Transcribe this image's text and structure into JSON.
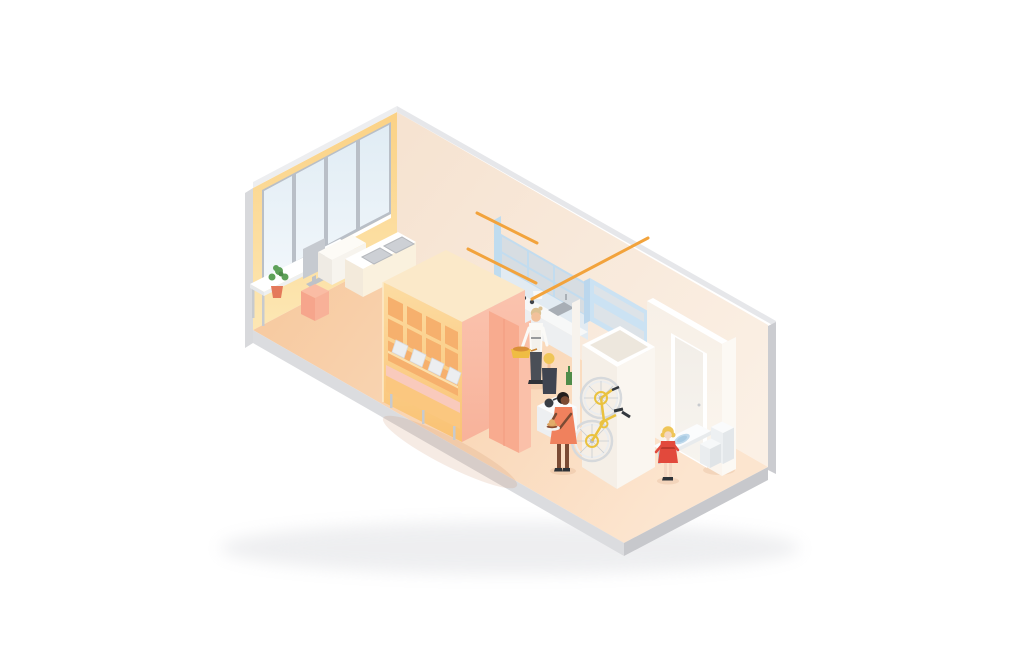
{
  "scene": {
    "description": "Isometric cutaway illustration of a compact studio apartment with window wall, desk, shelving bench unit, kitchen, bicycle storage closet, entry wall with door, fold-out washbasin table and toilet",
    "objects": [
      "window-wall",
      "desk-with-monitor",
      "potted-plant",
      "pink-storage-box",
      "sideboard",
      "cooktop-counter",
      "shelving-bench-unit",
      "wardrobe",
      "kitchen-cabinets",
      "kitchen-counter-sink",
      "chef-figure",
      "blonde-woman-figure",
      "serving-woman-figure",
      "kitchen-cart",
      "hanging-rails",
      "storage-closet",
      "wall-mounted-bicycle",
      "entry-wall-door",
      "fold-out-basin-table",
      "girl-figure",
      "toilet"
    ]
  },
  "colors": {
    "background": "#ffffff",
    "soft_shadow": "#cfd0d6",
    "slab_light": "#dbdcdf",
    "slab_dark": "#c7c8cc",
    "slab_edge_left": "#d8d9dc",
    "slab_top_nw": "#edeef0",
    "slab_top_ne": "#e6e7ea",
    "slab_right": "#cbccd0",
    "wall_yellow_top": "#fbd184",
    "wall_yellow_bottom": "#fce7b4",
    "wall_cream_dark": "#f6e3d1",
    "wall_cream_light": "#fbf0e5",
    "floor_dark": "#f7cba2",
    "floor_light": "#fce5cf",
    "window_frame": "#b9bfc7",
    "pane_top": "#e0ecf4",
    "pane_bottom": "#f2f7fb",
    "sill": "#ffffff",
    "desk_top": "#ffffff",
    "desk_edge": "#eef0f1",
    "desk_side": "#e6e8ea",
    "leg_gray": "#c7cace",
    "monitor": "#c6cad0",
    "monitor_stand": "#bec2c8",
    "keyboard": "#dadde0",
    "pot_orange": "#e4795a",
    "plant_green": "#5ea159",
    "plant_green_dark": "#4c8a49",
    "box_pink_top": "#fabca4",
    "box_pink_left": "#f6a58c",
    "box_pink_right": "#f8b198",
    "sideboard_top": "#fdfbf6",
    "sideboard_front": "#f7f4ee",
    "sideboard_side": "#efebe4",
    "counter_top": "#ffffff",
    "counter_front": "#faf1de",
    "counter_side": "#f3eadb",
    "hob_gray": "#cdd0d5",
    "hob_border": "#b5b8bd",
    "shelf_top": "#fbe9c9",
    "shelf_face_light": "#fcdca2",
    "shelf_face_dark": "#fac172",
    "cubby": "#f6b06d",
    "shelf_line": "#fce0ac",
    "shelf_edge_light": "#fdebc8",
    "salmon_light": "#fac3ae",
    "salmon_dark": "#f8b29a",
    "wardrobe_front": "#f8ab8f",
    "wardrobe_side": "#fac0a9",
    "wardrobe_seam": "#f29b7f",
    "bench_seat": "#f9cabc",
    "bench_front": "#fbc77f",
    "cushion": "#eceef0",
    "cushion_edge": "#d9dbde",
    "kitchen_blue_side": "#bfdcef",
    "cabinet_band": "#d7dde2",
    "cabinet_frame": "#c2dcef",
    "kitchen_wall": "#e2ebf2",
    "fridge_face": "#cbe2f3",
    "fridge_side": "#bbd7ed",
    "fridge_panel": "#dde3e8",
    "kcounter_top": "#f7f8f8",
    "kcounter_front": "#edeff1",
    "sink": "#a8aeb5",
    "faucet": "#9aa0a7",
    "rail_orange": "#f2a33c",
    "white_wall_warm": "#f5efe7",
    "white_wall_bright": "#faf6f0",
    "wall_interior": "#ede7dd",
    "wall_top_white": "#ffffff",
    "corridor_face_top": "#f7f0e7",
    "corridor_face_bottom": "#fbf5ee",
    "corridor_return": "#fcf9f4",
    "door_frame": "#ffffff",
    "door_top": "#f2eee8",
    "door_bottom": "#f7f4ef",
    "door_handle": "#c8cbcf",
    "column_white": "#f7f3ed",
    "table_top": "#fbfcfd",
    "table_edge": "#e8ebed",
    "basin_outer": "#bfd9ec",
    "basin_inner": "#a9cbe3",
    "toilet_top": "#fafbfc",
    "toilet_front": "#edf0f2",
    "toilet_side": "#e3e7ea",
    "bowl_top": "#f6f8f9",
    "bowl_front": "#eaedef",
    "bowl_side": "#e0e4e7",
    "skin_light": "#f2c19b",
    "skin_pale": "#f4d7c2",
    "skin_dark": "#7b4b34",
    "hair_blonde": "#efc557",
    "hair_sandy": "#dcc293",
    "hair_black": "#241f1e",
    "chef_white": "#fbfaf7",
    "apron": "#f3f1ec",
    "apron_tie": "#3e434b",
    "pants_dark": "#4a4f57",
    "shoe_dark": "#2e3237",
    "top_slate": "#3f4450",
    "dress_coral": "#f0815d",
    "dress_red": "#e2493c",
    "belt_red": "#b03228",
    "pot_yellow": "#efbc43",
    "pot_food": "#d98f39",
    "pot_handle": "#c98432",
    "plate_white": "#f4f4f2",
    "bun": "#d9a15e",
    "bun_top": "#e2ac6a",
    "patty": "#8a4a2e",
    "pan_dark": "#3a3e44",
    "bottle_green": "#4f8c49",
    "bike_yellow": "#eac23f",
    "tire": "#d6d9dc",
    "rim": "#ebedef",
    "spoke": "#c9cdd1",
    "hub": "#b9bec3",
    "bike_dark": "#33383e",
    "shadow": "rgba(196,130,88,0.16)"
  }
}
